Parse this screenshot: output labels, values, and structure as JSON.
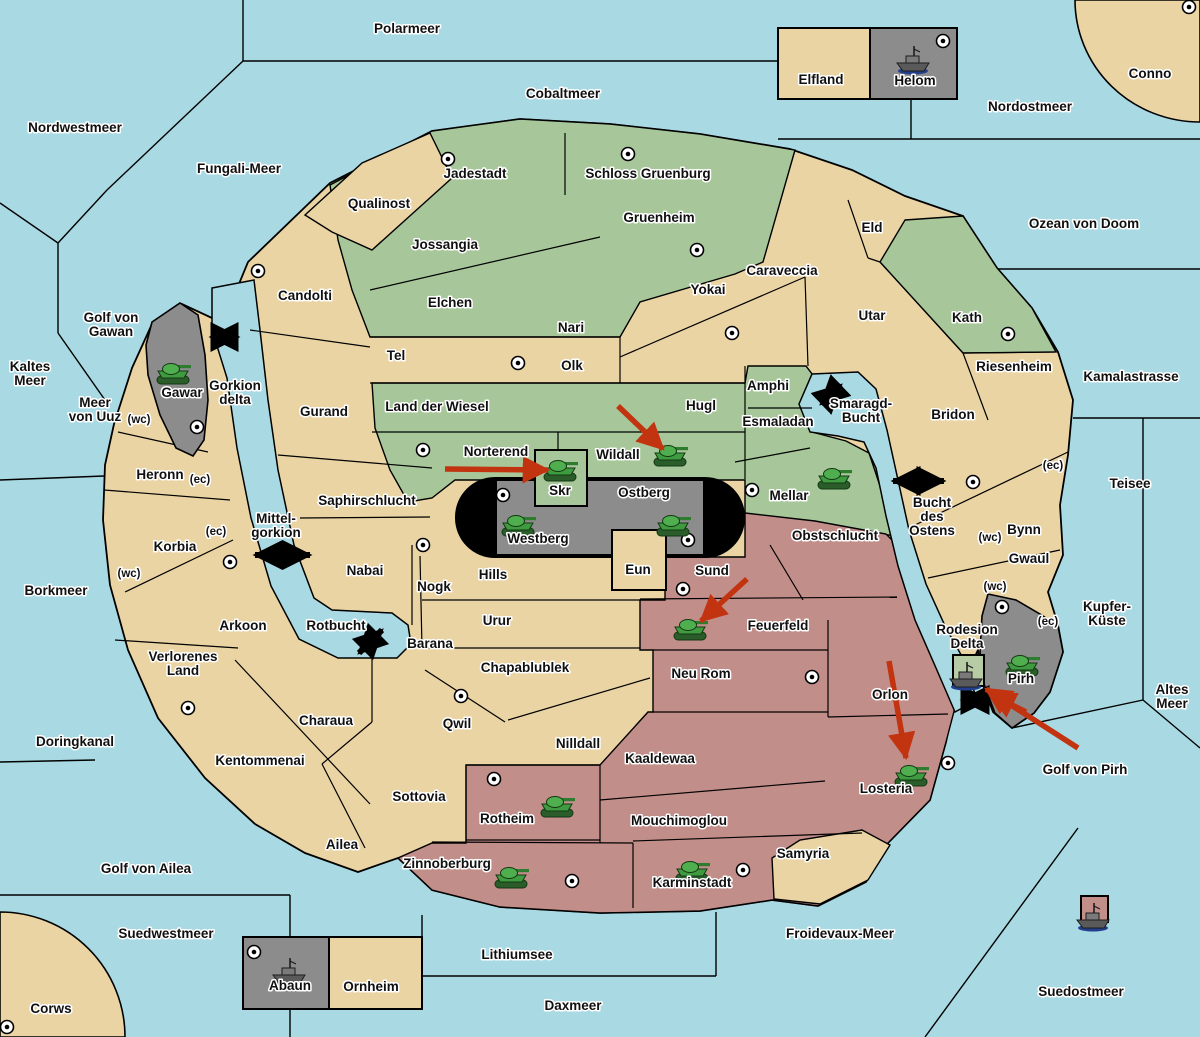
{
  "map": {
    "width": 1200,
    "height": 1037,
    "colors": {
      "water": "#A9DAE4",
      "land_tan": "#EAD4A4",
      "land_green": "#A7C79A",
      "land_pink": "#C28E8A",
      "land_gray": "#8C8C8C",
      "pill_black": "#000000",
      "delta_box_green": "#B7CCA4",
      "border": "#000000",
      "unit_green": "#3F9B3F",
      "arrow_red": "#C2330F"
    },
    "sea_labels": [
      {
        "name": "Polarmeer",
        "lines": [
          "Polarmeer"
        ],
        "x": 407,
        "y": 33
      },
      {
        "name": "Cobaltmeer",
        "lines": [
          "Cobaltmeer"
        ],
        "x": 563,
        "y": 98
      },
      {
        "name": "Nordostmeer",
        "lines": [
          "Nordostmeer"
        ],
        "x": 1030,
        "y": 111
      },
      {
        "name": "Nordwestmeer",
        "lines": [
          "Nordwestmeer"
        ],
        "x": 75,
        "y": 132
      },
      {
        "name": "Fungali-Meer",
        "lines": [
          "Fungali-Meer"
        ],
        "x": 239,
        "y": 173
      },
      {
        "name": "Ozean von Doom",
        "lines": [
          "Ozean von Doom"
        ],
        "x": 1084,
        "y": 228
      },
      {
        "name": "Golf von Gawan",
        "lines": [
          "Golf von",
          "Gawan"
        ],
        "x": 111,
        "y": 322
      },
      {
        "name": "Kaltes Meer",
        "lines": [
          "Kaltes",
          "Meer"
        ],
        "x": 30,
        "y": 371
      },
      {
        "name": "Meer von Uuz",
        "lines": [
          "Meer",
          "von Uuz"
        ],
        "x": 95,
        "y": 407
      },
      {
        "name": "Kamalastrasse",
        "lines": [
          "Kamalastrasse"
        ],
        "x": 1131,
        "y": 381
      },
      {
        "name": "Gorkion delta",
        "lines": [
          "Gorkion",
          "delta"
        ],
        "x": 235,
        "y": 390
      },
      {
        "name": "Smaragd-Bucht",
        "lines": [
          "Smaragd-",
          "Bucht"
        ],
        "x": 861,
        "y": 408
      },
      {
        "name": "Teisee",
        "lines": [
          "Teisee"
        ],
        "x": 1130,
        "y": 488
      },
      {
        "name": "Bucht des Ostens",
        "lines": [
          "Bucht",
          "des",
          "Ostens"
        ],
        "x": 932,
        "y": 507
      },
      {
        "name": "Mittel-gorkion",
        "lines": [
          "Mittel-",
          "gorkion"
        ],
        "x": 276,
        "y": 523
      },
      {
        "name": "Borkmeer",
        "lines": [
          "Borkmeer"
        ],
        "x": 56,
        "y": 595
      },
      {
        "name": "Kupfer-Kueste",
        "lines": [
          "Kupfer-",
          "Küste"
        ],
        "x": 1107,
        "y": 611
      },
      {
        "name": "Rotbucht",
        "lines": [
          "Rotbucht"
        ],
        "x": 336,
        "y": 630
      },
      {
        "name": "Rodesion Delta",
        "lines": [
          "Rodesion",
          "Delta"
        ],
        "x": 967,
        "y": 634
      },
      {
        "name": "Altes Meer",
        "lines": [
          "Altes",
          "Meer"
        ],
        "x": 1172,
        "y": 694
      },
      {
        "name": "Doringkanal",
        "lines": [
          "Doringkanal"
        ],
        "x": 75,
        "y": 746
      },
      {
        "name": "Golf von Pirh",
        "lines": [
          "Golf von Pirh"
        ],
        "x": 1085,
        "y": 774
      },
      {
        "name": "Golf von Ailea",
        "lines": [
          "Golf von Ailea"
        ],
        "x": 146,
        "y": 873
      },
      {
        "name": "Suedwestmeer",
        "lines": [
          "Suedwestmeer"
        ],
        "x": 166,
        "y": 938
      },
      {
        "name": "Froidevaux-Meer",
        "lines": [
          "Froidevaux-Meer"
        ],
        "x": 840,
        "y": 938
      },
      {
        "name": "Lithiumsee",
        "lines": [
          "Lithiumsee"
        ],
        "x": 517,
        "y": 959
      },
      {
        "name": "Suedostmeer",
        "lines": [
          "Suedostmeer"
        ],
        "x": 1081,
        "y": 996
      },
      {
        "name": "Daxmeer",
        "lines": [
          "Daxmeer"
        ],
        "x": 573,
        "y": 1010
      }
    ],
    "land_labels": [
      {
        "name": "Conno",
        "lines": [
          "Conno"
        ],
        "x": 1150,
        "y": 78
      },
      {
        "name": "Elfland",
        "lines": [
          "Elfland"
        ],
        "x": 821,
        "y": 84
      },
      {
        "name": "Helom",
        "lines": [
          "Helom"
        ],
        "x": 915,
        "y": 85
      },
      {
        "name": "Jadestadt",
        "lines": [
          "Jadestadt"
        ],
        "x": 475,
        "y": 178
      },
      {
        "name": "Schloss Gruenburg",
        "lines": [
          "Schloss Gruenburg"
        ],
        "x": 648,
        "y": 178
      },
      {
        "name": "Qualinost",
        "lines": [
          "Qualinost"
        ],
        "x": 379,
        "y": 208
      },
      {
        "name": "Gruenheim",
        "lines": [
          "Gruenheim"
        ],
        "x": 659,
        "y": 222
      },
      {
        "name": "Eld",
        "lines": [
          "Eld"
        ],
        "x": 872,
        "y": 232
      },
      {
        "name": "Jossangia",
        "lines": [
          "Jossangia"
        ],
        "x": 445,
        "y": 249
      },
      {
        "name": "Candolti",
        "lines": [
          "Candolti"
        ],
        "x": 305,
        "y": 300
      },
      {
        "name": "Elchen",
        "lines": [
          "Elchen"
        ],
        "x": 450,
        "y": 307
      },
      {
        "name": "Yokai",
        "lines": [
          "Yokai"
        ],
        "x": 708,
        "y": 294
      },
      {
        "name": "Caraveccia",
        "lines": [
          "Caraveccia"
        ],
        "x": 782,
        "y": 275
      },
      {
        "name": "Utar",
        "lines": [
          "Utar"
        ],
        "x": 872,
        "y": 320
      },
      {
        "name": "Kath",
        "lines": [
          "Kath"
        ],
        "x": 967,
        "y": 322
      },
      {
        "name": "Nari",
        "lines": [
          "Nari"
        ],
        "x": 571,
        "y": 332
      },
      {
        "name": "Tel",
        "lines": [
          "Tel"
        ],
        "x": 396,
        "y": 360
      },
      {
        "name": "Olk",
        "lines": [
          "Olk"
        ],
        "x": 572,
        "y": 370
      },
      {
        "name": "Riesenheim",
        "lines": [
          "Riesenheim"
        ],
        "x": 1014,
        "y": 371
      },
      {
        "name": "Amphi",
        "lines": [
          "Amphi"
        ],
        "x": 768,
        "y": 390
      },
      {
        "name": "Gawar",
        "lines": [
          "Gawar"
        ],
        "x": 182,
        "y": 397
      },
      {
        "name": "Gurand",
        "lines": [
          "Gurand"
        ],
        "x": 324,
        "y": 416
      },
      {
        "name": "Land der Wiesel",
        "lines": [
          "Land der Wiesel"
        ],
        "x": 437,
        "y": 411
      },
      {
        "name": "Hugl",
        "lines": [
          "Hugl"
        ],
        "x": 701,
        "y": 410
      },
      {
        "name": "Bridon",
        "lines": [
          "Bridon"
        ],
        "x": 953,
        "y": 419
      },
      {
        "name": "Esmaladan",
        "lines": [
          "Esmaladan"
        ],
        "x": 778,
        "y": 426
      },
      {
        "name": "Norterend",
        "lines": [
          "Norterend"
        ],
        "x": 496,
        "y": 456
      },
      {
        "name": "Wildall",
        "lines": [
          "Wildall"
        ],
        "x": 618,
        "y": 459
      },
      {
        "name": "Heronn",
        "lines": [
          "Heronn"
        ],
        "x": 160,
        "y": 479
      },
      {
        "name": "Skr",
        "lines": [
          "Skr"
        ],
        "x": 560,
        "y": 495
      },
      {
        "name": "Ostberg",
        "lines": [
          "Ostberg"
        ],
        "x": 644,
        "y": 497
      },
      {
        "name": "Mellar",
        "lines": [
          "Mellar"
        ],
        "x": 789,
        "y": 500
      },
      {
        "name": "Saphirschlucht",
        "lines": [
          "Saphirschlucht"
        ],
        "x": 367,
        "y": 505
      },
      {
        "name": "Bynn",
        "lines": [
          "Bynn"
        ],
        "x": 1024,
        "y": 534
      },
      {
        "name": "Obstschlucht",
        "lines": [
          "Obstschlucht"
        ],
        "x": 835,
        "y": 540
      },
      {
        "name": "Westberg",
        "lines": [
          "Westberg"
        ],
        "x": 538,
        "y": 543
      },
      {
        "name": "Korbia",
        "lines": [
          "Korbia"
        ],
        "x": 175,
        "y": 551
      },
      {
        "name": "Gwaul",
        "lines": [
          "Gwaul"
        ],
        "x": 1029,
        "y": 563
      },
      {
        "name": "Nabai",
        "lines": [
          "Nabai"
        ],
        "x": 365,
        "y": 575
      },
      {
        "name": "Eun",
        "lines": [
          "Eun"
        ],
        "x": 638,
        "y": 574
      },
      {
        "name": "Sund",
        "lines": [
          "Sund"
        ],
        "x": 712,
        "y": 575
      },
      {
        "name": "Hills",
        "lines": [
          "Hills"
        ],
        "x": 493,
        "y": 579
      },
      {
        "name": "Nogk",
        "lines": [
          "Nogk"
        ],
        "x": 434,
        "y": 591
      },
      {
        "name": "Urur",
        "lines": [
          "Urur"
        ],
        "x": 497,
        "y": 625
      },
      {
        "name": "Arkoon",
        "lines": [
          "Arkoon"
        ],
        "x": 243,
        "y": 630
      },
      {
        "name": "Feuerfeld",
        "lines": [
          "Feuerfeld"
        ],
        "x": 778,
        "y": 630
      },
      {
        "name": "Barana",
        "lines": [
          "Barana"
        ],
        "x": 430,
        "y": 648
      },
      {
        "name": "Verlorenes Land",
        "lines": [
          "Verlorenes",
          "Land"
        ],
        "x": 183,
        "y": 661
      },
      {
        "name": "Chapablublek",
        "lines": [
          "Chapablublek"
        ],
        "x": 525,
        "y": 672
      },
      {
        "name": "Neu Rom",
        "lines": [
          "Neu Rom"
        ],
        "x": 701,
        "y": 678
      },
      {
        "name": "Pirh",
        "lines": [
          "Pirh"
        ],
        "x": 1021,
        "y": 683
      },
      {
        "name": "Orlon",
        "lines": [
          "Orlon"
        ],
        "x": 890,
        "y": 699
      },
      {
        "name": "Charaua",
        "lines": [
          "Charaua"
        ],
        "x": 326,
        "y": 725
      },
      {
        "name": "Qwil",
        "lines": [
          "Qwil"
        ],
        "x": 457,
        "y": 728
      },
      {
        "name": "Nilldall",
        "lines": [
          "Nilldall"
        ],
        "x": 578,
        "y": 748
      },
      {
        "name": "Kaaldewaa",
        "lines": [
          "Kaaldewaa"
        ],
        "x": 660,
        "y": 763
      },
      {
        "name": "Kentommenai",
        "lines": [
          "Kentommenai"
        ],
        "x": 260,
        "y": 765
      },
      {
        "name": "Losteria",
        "lines": [
          "Losteria"
        ],
        "x": 886,
        "y": 793
      },
      {
        "name": "Sottovia",
        "lines": [
          "Sottovia"
        ],
        "x": 419,
        "y": 801
      },
      {
        "name": "Rotheim",
        "lines": [
          "Rotheim"
        ],
        "x": 507,
        "y": 823
      },
      {
        "name": "Mouchimoglou",
        "lines": [
          "Mouchimoglou"
        ],
        "x": 679,
        "y": 825
      },
      {
        "name": "Ailea",
        "lines": [
          "Ailea"
        ],
        "x": 342,
        "y": 849
      },
      {
        "name": "Samyria",
        "lines": [
          "Samyria"
        ],
        "x": 803,
        "y": 858
      },
      {
        "name": "Zinnoberburg",
        "lines": [
          "Zinnoberburg"
        ],
        "x": 447,
        "y": 868
      },
      {
        "name": "Karminstadt",
        "lines": [
          "Karminstadt"
        ],
        "x": 692,
        "y": 887
      },
      {
        "name": "Abaun",
        "lines": [
          "Abaun"
        ],
        "x": 290,
        "y": 990
      },
      {
        "name": "Ornheim",
        "lines": [
          "Ornheim"
        ],
        "x": 371,
        "y": 991
      },
      {
        "name": "Corws",
        "lines": [
          "Corws"
        ],
        "x": 51,
        "y": 1013
      }
    ],
    "coast_badges": [
      {
        "text": "(wc)",
        "x": 139,
        "y": 419
      },
      {
        "text": "(ec)",
        "x": 200,
        "y": 479
      },
      {
        "text": "(ec)",
        "x": 216,
        "y": 531
      },
      {
        "text": "(wc)",
        "x": 129,
        "y": 573
      },
      {
        "text": "(ec)",
        "x": 1053,
        "y": 465
      },
      {
        "text": "(wc)",
        "x": 990,
        "y": 537
      },
      {
        "text": "(wc)",
        "x": 995,
        "y": 586
      },
      {
        "text": "(ec)",
        "x": 1048,
        "y": 621
      }
    ],
    "supply_centers": [
      {
        "region": "Jadestadt",
        "x": 448,
        "y": 159
      },
      {
        "region": "Schloss Gruenburg",
        "x": 628,
        "y": 154
      },
      {
        "region": "Gruenheim",
        "x": 697,
        "y": 250
      },
      {
        "region": "Candolti",
        "x": 258,
        "y": 271
      },
      {
        "region": "Yokai",
        "x": 732,
        "y": 333
      },
      {
        "region": "Tel",
        "x": 518,
        "y": 363
      },
      {
        "region": "Kath",
        "x": 1008,
        "y": 334
      },
      {
        "region": "Helom",
        "x": 943,
        "y": 41
      },
      {
        "region": "Conno",
        "x": 1189,
        "y": 7
      },
      {
        "region": "Gawar",
        "x": 197,
        "y": 427
      },
      {
        "region": "Norterend",
        "x": 423,
        "y": 450
      },
      {
        "region": "Westberg",
        "x": 503,
        "y": 495
      },
      {
        "region": "Ostberg",
        "x": 688,
        "y": 540
      },
      {
        "region": "Mellar",
        "x": 752,
        "y": 490
      },
      {
        "region": "Bynn",
        "x": 973,
        "y": 482
      },
      {
        "region": "Pirh",
        "x": 1002,
        "y": 607
      },
      {
        "region": "Hills",
        "x": 423,
        "y": 545
      },
      {
        "region": "Sund",
        "x": 683,
        "y": 589
      },
      {
        "region": "Neu Rom",
        "x": 812,
        "y": 677
      },
      {
        "region": "Korbia",
        "x": 230,
        "y": 562
      },
      {
        "region": "Kentommenai",
        "x": 188,
        "y": 708
      },
      {
        "region": "Qwil",
        "x": 461,
        "y": 696
      },
      {
        "region": "Rotheim",
        "x": 494,
        "y": 779
      },
      {
        "region": "Losteria",
        "x": 948,
        "y": 763
      },
      {
        "region": "Karminstadt",
        "x": 743,
        "y": 870
      },
      {
        "region": "Zinnoberburg",
        "x": 572,
        "y": 881
      },
      {
        "region": "Abaun",
        "x": 254,
        "y": 952
      },
      {
        "region": "Corws",
        "x": 7,
        "y": 1027
      }
    ],
    "armies": [
      {
        "region": "Gawar",
        "x": 173,
        "y": 373
      },
      {
        "region": "Wildall",
        "x": 670,
        "y": 455
      },
      {
        "region": "Skr",
        "x": 560,
        "y": 470
      },
      {
        "region": "Mellar",
        "x": 834,
        "y": 478
      },
      {
        "region": "Westberg",
        "x": 518,
        "y": 525
      },
      {
        "region": "Ostberg",
        "x": 673,
        "y": 525
      },
      {
        "region": "Feuerfeld",
        "x": 690,
        "y": 629
      },
      {
        "region": "Pirh",
        "x": 1022,
        "y": 665
      },
      {
        "region": "Losteria",
        "x": 911,
        "y": 775
      },
      {
        "region": "Rotheim",
        "x": 557,
        "y": 806
      },
      {
        "region": "Zinnoberburg",
        "x": 511,
        "y": 877
      },
      {
        "region": "Karminstadt",
        "x": 692,
        "y": 871
      }
    ],
    "fleets": [
      {
        "region": "Helom",
        "x": 913,
        "y": 61
      },
      {
        "region": "Abaun",
        "x": 289,
        "y": 973
      },
      {
        "region": "Rodesion Delta",
        "x": 966,
        "y": 677
      },
      {
        "region": "Suedostmeer",
        "x": 1093,
        "y": 918
      }
    ],
    "move_arrows": [
      {
        "x1": 445,
        "y1": 469,
        "x2": 548,
        "y2": 470
      },
      {
        "x1": 618,
        "y1": 406,
        "x2": 663,
        "y2": 449
      },
      {
        "x1": 747,
        "y1": 579,
        "x2": 701,
        "y2": 621
      },
      {
        "x1": 889,
        "y1": 661,
        "x2": 906,
        "y2": 758
      },
      {
        "x1": 1078,
        "y1": 748,
        "x2": 986,
        "y2": 689
      },
      {
        "x1": 1026,
        "y1": 712,
        "x2": 990,
        "y2": 694
      }
    ],
    "link_arrows": [
      {
        "x1": 211,
        "y1": 337,
        "x2": 238,
        "y2": 337
      },
      {
        "x1": 821,
        "y1": 404,
        "x2": 841,
        "y2": 385
      },
      {
        "x1": 893,
        "y1": 481,
        "x2": 944,
        "y2": 481
      },
      {
        "x1": 255,
        "y1": 555,
        "x2": 310,
        "y2": 555
      },
      {
        "x1": 359,
        "y1": 653,
        "x2": 382,
        "y2": 630
      },
      {
        "x1": 962,
        "y1": 700,
        "x2": 988,
        "y2": 700
      }
    ]
  }
}
